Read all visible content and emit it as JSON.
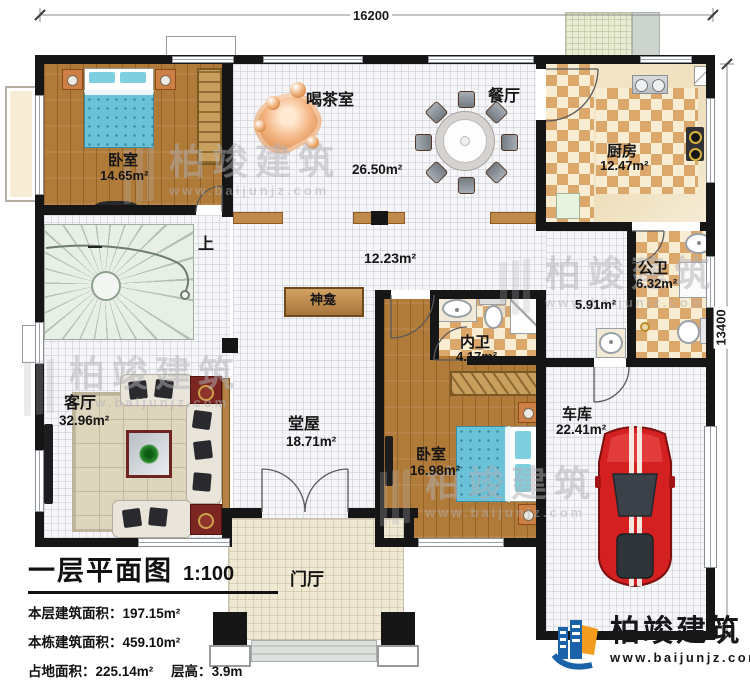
{
  "dimensions": {
    "width_mm": "16200",
    "height_mm": "13400"
  },
  "rooms": {
    "bedroom1": {
      "name": "卧室",
      "area": "14.65m²"
    },
    "tea_room": {
      "name": "喝茶室",
      "area": "26.50m²"
    },
    "dining": {
      "name": "餐厅"
    },
    "kitchen": {
      "name": "厨房",
      "area": "12.47m²"
    },
    "public_bath": {
      "name": "公卫",
      "area": "6.32m²"
    },
    "hallway": {
      "area": "5.91m²"
    },
    "corridor": {
      "area": "12.23m²"
    },
    "ensuite_bath": {
      "name": "内卫",
      "area": "4.17m²"
    },
    "bedroom2": {
      "name": "卧室",
      "area": "16.98m²"
    },
    "garage": {
      "name": "车库",
      "area": "22.41m²"
    },
    "living_room": {
      "name": "客厅",
      "area": "32.96m²"
    },
    "main_hall": {
      "name": "堂屋",
      "area": "18.71m²"
    },
    "shrine": {
      "name": "神龛"
    },
    "foyer": {
      "name": "门厅"
    },
    "stairs": {
      "direction_label": "上"
    }
  },
  "title_block": {
    "title": "一层平面图",
    "scale": "1:100",
    "floor_area_label": "本层建筑面积：",
    "floor_area_value": "197.15m²",
    "total_area_label": "本栋建筑面积：",
    "total_area_value": "459.10m²",
    "footprint_label": "占地面积：",
    "footprint_value": "225.14m²",
    "floor_height_label": "层高：",
    "floor_height_value": "3.9m"
  },
  "branding": {
    "company": "柏竣建筑",
    "website": "www.baijunjz.com"
  },
  "watermark": {
    "text": "柏竣建筑",
    "url": "www.baijunjz.com"
  }
}
